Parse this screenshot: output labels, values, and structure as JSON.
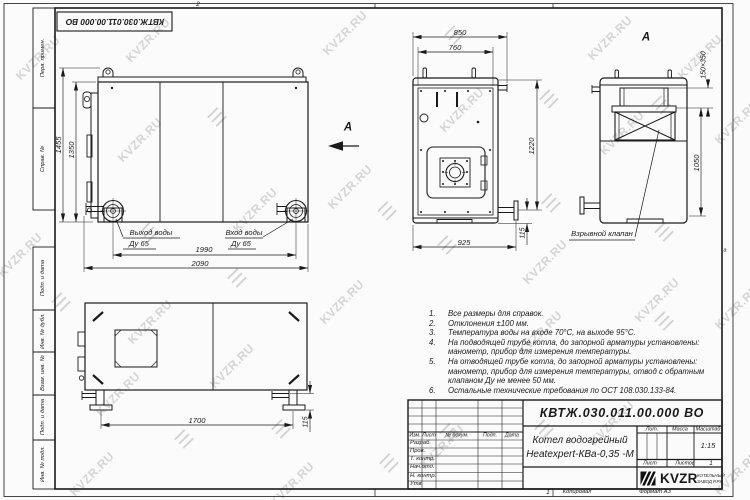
{
  "watermark": {
    "text": "KVZR.RU",
    "glyph": "☰"
  },
  "frame": {
    "stamp_top": "КВТЖ.030.011.00.000 ВО",
    "zone_top": "2",
    "zone_bottom": "1",
    "zone_right": "а",
    "copied_label": "Копировал",
    "format_label": "Формат А3",
    "side_labels": [
      "Перв. примен.",
      "Справ. №",
      "Подп. и дата",
      "Инв. № дубл.",
      "Взам. инв. №",
      "Подп. и дата",
      "Инв. № подл."
    ]
  },
  "views": {
    "side": {
      "dim_height_total": "1455",
      "dim_height_body": "1350",
      "dim_width_flanges": "1990",
      "dim_width_total": "2090",
      "outlet_label": "Выход воды",
      "outlet_dn": "Ду 65",
      "inlet_label": "Вход воды",
      "inlet_dn": "Ду 65",
      "view_arrow_label": "А"
    },
    "rear": {
      "dim_width_total": "850",
      "dim_width_inner": "760",
      "dim_height": "1220",
      "dim_width_base": "925",
      "dim_flange_offset": "115"
    },
    "front": {
      "view_label": "А",
      "dim_chimney": "150×350",
      "dim_height": "1050",
      "valve_label": "Взрывной клапан"
    },
    "top": {
      "dim_length_legs": "1700",
      "dim_foot": "115"
    }
  },
  "notes": [
    {
      "n": "1.",
      "lines": [
        "Все размеры для справок."
      ]
    },
    {
      "n": "2.",
      "lines": [
        "Отклонения ±100 мм."
      ]
    },
    {
      "n": "3.",
      "lines": [
        "Температура воды на входе 70°С, на выходе 95°С."
      ]
    },
    {
      "n": "4.",
      "lines": [
        "На подводящей трубе котла, до запорной арматуры установлены:",
        "манометр, прибор для измерения температуры."
      ]
    },
    {
      "n": "5.",
      "lines": [
        "На отводящей трубе котла, до запорной арматуры установлены:",
        "манометр, прибор для измерения температуры, отвод с обратным",
        "клапаном Ду не менее 50 мм."
      ]
    },
    {
      "n": "6.",
      "lines": [
        "Остальные технические требования по ОСТ 108.030.133-84."
      ]
    }
  ],
  "title_block": {
    "doc_number": "КВТЖ.030.011.00.000 ВО",
    "product_line1": "Котел водогрейный",
    "product_line2": "Heatexpert-КВа-0,35 -М",
    "cols": [
      "Изм.",
      "Лист",
      "№ докум.",
      "Подп.",
      "Дата"
    ],
    "rows": [
      "Разраб.",
      "Пров.",
      "Т. контр.",
      "Нач.отд.",
      "Н. контр.",
      "Утв."
    ],
    "lit_label": "Лит.",
    "mass_label": "Масса",
    "scale_label": "Масштаб",
    "scale_value": "1:15",
    "sheet_label": "Лист",
    "sheets_label": "Листов",
    "sheets_value": "1",
    "logo_text": "KVZR",
    "logo_sub1": "КОТЕЛЬНЫЙ",
    "logo_sub2": "ЗАВОД Р.РУ"
  },
  "colors": {
    "line": "#1a1a1a",
    "watermark": "#d5d5d5",
    "background": "#fbfbfb"
  }
}
